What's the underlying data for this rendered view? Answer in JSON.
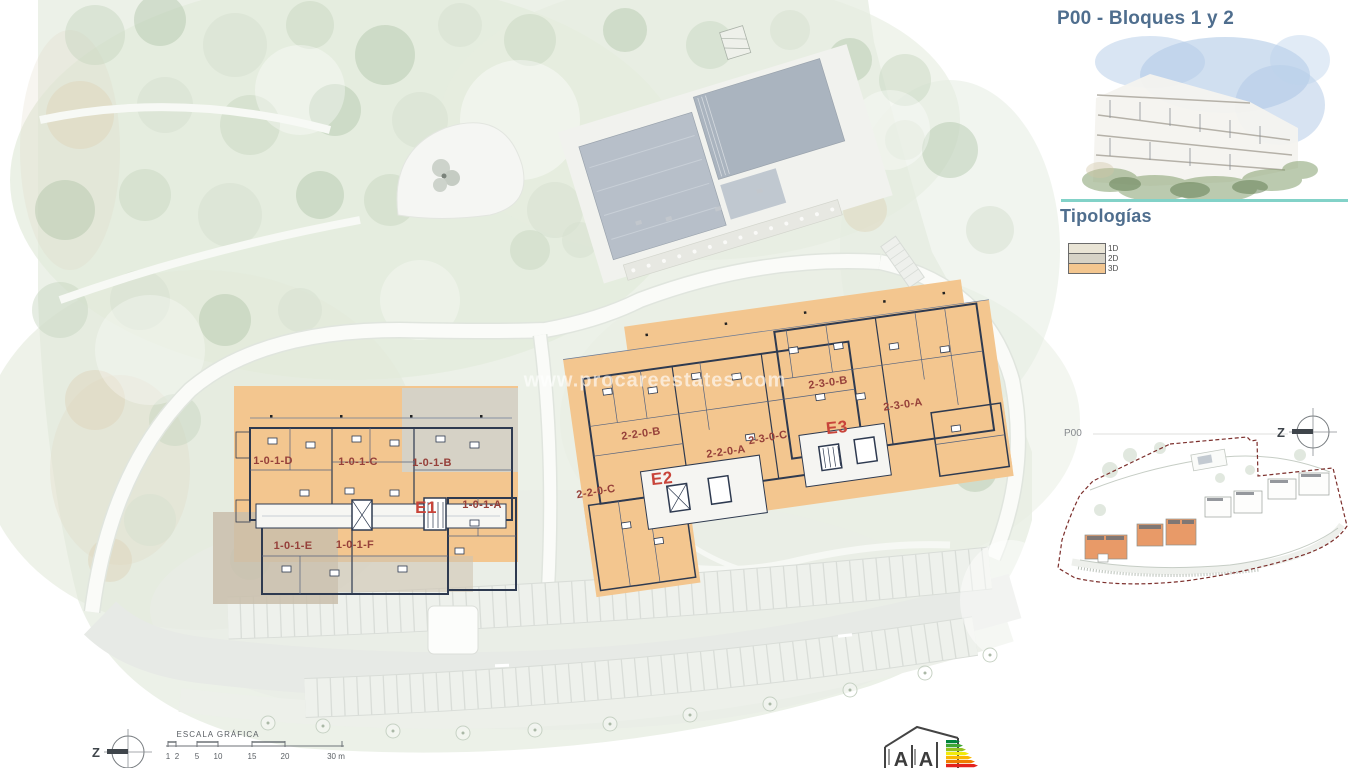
{
  "panel": {
    "title": "P00 - Bloques 1 y 2",
    "section_title": "Tipologías",
    "legend": [
      {
        "code": "1D",
        "color": "#e9e4d5"
      },
      {
        "code": "2D",
        "color": "#d6d2c6"
      },
      {
        "code": "3D",
        "color": "#f3c68f"
      }
    ]
  },
  "plan": {
    "watermark": "www.procareestates.com",
    "e1": {
      "name": "E1",
      "u_d": "1-0-1-D",
      "u_c": "1-0-1-C",
      "u_b": "1-0-1-B",
      "u_a": "1-0-1-A",
      "u_e": "1-0-1-E",
      "u_f": "1-0-1-F"
    },
    "e2": {
      "name": "E2",
      "u_b": "2-2-0-B",
      "u_a": "2-2-0-A",
      "u_c": "2-2-0-C"
    },
    "e3": {
      "name": "E3",
      "u_b": "2-3-0-B",
      "u_a": "2-3-0-A",
      "u_c": "2-3-0-C"
    }
  },
  "keyplan": {
    "label": "P00",
    "north_label": "Z"
  },
  "compass": {
    "north_label": "Z"
  },
  "scalebar": {
    "title": "ESCALA GRÁFICA",
    "ticks": [
      "1",
      "2",
      "5",
      "10",
      "15",
      "20",
      "30 m"
    ]
  },
  "energy": {
    "letters": [
      "A",
      "A"
    ]
  },
  "colors": {
    "accent_teal": "#82d2c8",
    "title_blue": "#4f6e8e",
    "unit_label_maroon": "#96403a",
    "building_label_red": "#c8443a",
    "boundary_maroon": "#7c2f2c",
    "plan_orange_3d": "#f3c68f",
    "plan_gray_2d": "#d6d2c6",
    "plan_cream_1d": "#e9e4d5",
    "wall_line": "#2e3a50",
    "keyplan_building_orange": "#e89a68"
  }
}
